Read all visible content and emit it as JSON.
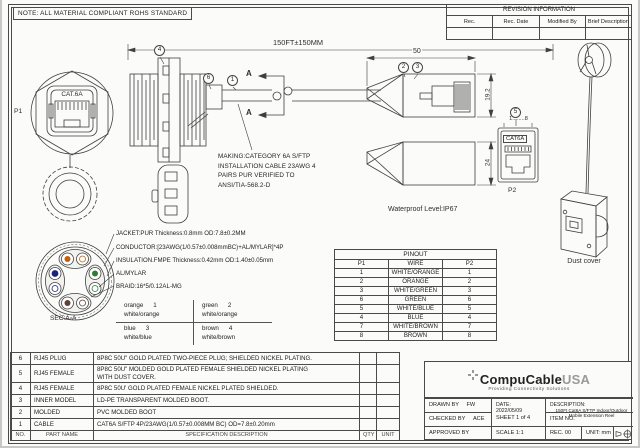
{
  "note": "NOTE: ALL MATERIAL COMPLIANT ROHS STANDARD",
  "revision": {
    "title": "REVISION INFORMATION",
    "col_rec": "Rec.",
    "col_date": "Rec. Date",
    "col_modified": "Modified By",
    "col_desc": "Brief Description"
  },
  "drawing": {
    "p1": "P1",
    "p2": "P2",
    "jack_label": "CAT.6A",
    "female_label": "CAT6A",
    "section_label": "SEC:A-A",
    "section_arrow_top": "A",
    "section_arrow_bottom": "A",
    "dim_overall": "150FT±150MM",
    "dim_plug_len": "50",
    "dim_plug_h": "19.2",
    "dim_boot_h": "24",
    "pin_numbers": "1........8",
    "waterproof": "Waterproof Level:IP67",
    "dust_cover": "Dust cover",
    "balloons": {
      "b1": "1",
      "b2": "2",
      "b3": "3",
      "b4": "4",
      "b5": "5",
      "b6": "6"
    },
    "making": [
      "MAKING:CATEGORY 6A S/FTP",
      "INSTALLATION CABLE 23AWG 4",
      "PAIRS PUR VERIFIED TO",
      "ANSI/TIA-568.2-D"
    ],
    "construction": [
      "JACKET:PUR Thickness:0.8mm OD:7.8±0.2MM",
      "CONDUCTOR:[23AWG(1/0.57±0.008mmBC)+AL/MYLAR]*4P",
      "INSULATION.FMPE Thickness:0.42mm OD:1.40±0.05mm",
      "AL/MYLAR",
      "BRAID:16*5/0.12AL-MG"
    ],
    "pairs": [
      {
        "color": "orange",
        "pin": "1",
        "stripe": "white/orange"
      },
      {
        "color": "green",
        "pin": "2",
        "stripe": "white/orange"
      },
      {
        "color": "blue",
        "pin": "3",
        "stripe": "white/blue"
      },
      {
        "color": "brown",
        "pin": "4",
        "stripe": "white/brown"
      }
    ],
    "pair_colors": {
      "orange": "#c06010",
      "green": "#2e7d32",
      "blue": "#1a237e",
      "brown": "#5d4037"
    }
  },
  "pinout": {
    "title": "PINOUT",
    "headers": [
      "P1",
      "WIRE",
      "P2"
    ],
    "rows": [
      [
        "1",
        "WHITE/ORANGE",
        "1"
      ],
      [
        "2",
        "ORANGE",
        "2"
      ],
      [
        "3",
        "WHITE/GREEN",
        "3"
      ],
      [
        "6",
        "GREEN",
        "6"
      ],
      [
        "5",
        "WHITE/BLUE",
        "5"
      ],
      [
        "4",
        "BLUE",
        "4"
      ],
      [
        "7",
        "WHITE/BROWN",
        "7"
      ],
      [
        "8",
        "BROWN",
        "8"
      ]
    ]
  },
  "parts": {
    "rows": [
      {
        "no": "6",
        "name": "RJ45 PLUG",
        "spec": "8P8C 50U\" GOLD PLATED  TWO-PIECE PLUG; SHIELDED NICKEL PLATING."
      },
      {
        "no": "5",
        "name": "RJ45 FEMALE",
        "spec": "8P8C 50U\" MOLDED GOLD PLATED FEMALE SHIELDED NICKEL PLATING",
        "spec2": "WITH DUST COVER."
      },
      {
        "no": "4",
        "name": "RJ45 FEMALE",
        "spec": "8P8C 50U' GOLD PLATED FEMALE NICKEL PLATED SHIELDED."
      },
      {
        "no": "3",
        "name": "INNER MODEL",
        "spec": "LD-PE TRANSPARENT MOLDED BOOT."
      },
      {
        "no": "2",
        "name": "MOLDED",
        "spec": "PVC MOLDED BOOT"
      },
      {
        "no": "1",
        "name": "CABLE",
        "spec": "CAT6A S/FTP 4P/23AWG(1/0.57±0.008MM BC)  OD=7.8±0.20mm"
      }
    ],
    "footer": {
      "no": "NO.",
      "name": "PART NAME",
      "spec": "SPECIFICATION DESCRIPTION",
      "qty": "QTY",
      "unit": "UNIT"
    }
  },
  "titleblock": {
    "company_bold": "CompuCable",
    "company_light": "USA",
    "tagline": "Providing Connectivity Solutions",
    "drawn_label": "DRAWN BY",
    "drawn": "FW",
    "checked_label": "CHECKED BY",
    "checked": "ACE",
    "approved_label": "APPROVED BY",
    "date_label": "DATE:",
    "date": "2022/05/09",
    "sheet": "SHEET 1 of 4",
    "scale": "SCALE 1:1",
    "desc_label": "DESCRIPTION:",
    "desc1": "150Ft Cat6A S/FTP Indoor/Outdoor",
    "desc2": "Mobile Extension Reel",
    "item": "ITEM NO.",
    "rec": "REC. 00",
    "unit": "UNIT: mm"
  }
}
